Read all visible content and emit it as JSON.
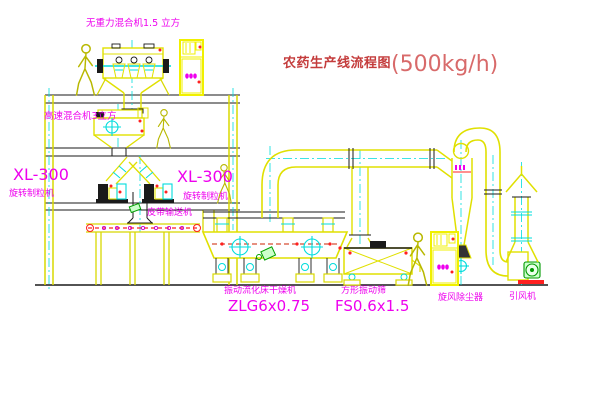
{
  "title": {
    "text": "农药生产线流程图",
    "capacity": "(500kg/h)"
  },
  "labels": {
    "mixer_top": "无重力混合机1.5 立方",
    "mixer_2f": "高速混合机3立方",
    "xl300_left": "XL-300",
    "granulator_left": "旋转制粒机",
    "xl300_mid": "XL-300",
    "granulator_mid": "旋转制粒机",
    "belt_conveyor": "皮带输送机",
    "dryer_name": "振动流化床干燥机",
    "dryer_model": "ZLG6x0.75",
    "sieve_name": "方形振动筛",
    "sieve_model": "FS0.6x1.5",
    "cyclone": "旋风除尘器",
    "fan": "引风机"
  },
  "colors": {
    "magenta": "#ee00ee",
    "title_red": "#c43c3c",
    "capacity_red": "#d86a6a",
    "yellow": "#e8e800",
    "cyan": "#00dcdc",
    "green": "#00a000",
    "red": "#ff2020",
    "black": "#1a1a1a"
  }
}
